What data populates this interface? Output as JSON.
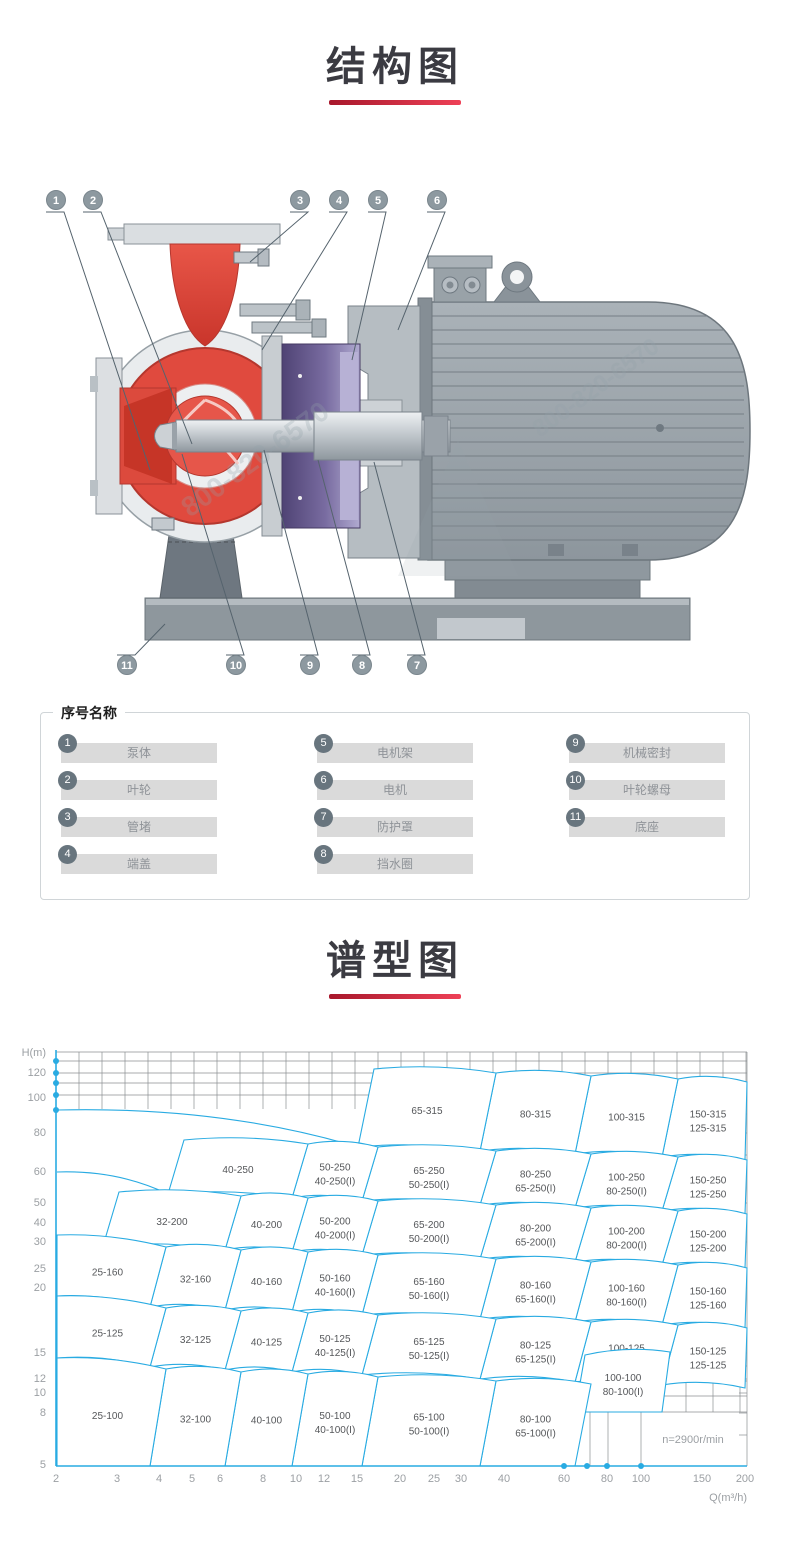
{
  "sections": {
    "structure": {
      "title": "结构图"
    },
    "spectrum": {
      "title": "谱型图"
    }
  },
  "accent": {
    "underline_from": "#a8182c",
    "underline_to": "#ee4157"
  },
  "figure": {
    "watermark": "800-820-6570",
    "colors": {
      "red": "#e04a3e",
      "dark_red": "#b5372e",
      "purple": "#5a4b7e",
      "motor_gray": "#9aa3a9",
      "base_gray": "#8e979d",
      "callout": "#8d99a0"
    },
    "callouts": [
      {
        "n": "1",
        "cx": 56,
        "cy": 22,
        "tx": 150,
        "ty": 292
      },
      {
        "n": "2",
        "cx": 93,
        "cy": 22,
        "tx": 192,
        "ty": 266
      },
      {
        "n": "3",
        "cx": 300,
        "cy": 22,
        "tx": 250,
        "ty": 84
      },
      {
        "n": "4",
        "cx": 339,
        "cy": 22,
        "tx": 262,
        "ty": 172
      },
      {
        "n": "5",
        "cx": 378,
        "cy": 22,
        "tx": 352,
        "ty": 182
      },
      {
        "n": "6",
        "cx": 437,
        "cy": 22,
        "tx": 398,
        "ty": 152
      },
      {
        "n": "11",
        "cx": 127,
        "cy": 487,
        "tx": 165,
        "ty": 446
      },
      {
        "n": "10",
        "cx": 236,
        "cy": 487,
        "tx": 182,
        "ty": 276
      },
      {
        "n": "9",
        "cx": 310,
        "cy": 487,
        "tx": 264,
        "ty": 272
      },
      {
        "n": "8",
        "cx": 362,
        "cy": 487,
        "tx": 318,
        "ty": 282
      },
      {
        "n": "7",
        "cx": 417,
        "cy": 487,
        "tx": 374,
        "ty": 284
      }
    ]
  },
  "legend": {
    "title": "序号名称",
    "items": [
      {
        "num": "1",
        "name": "泵体"
      },
      {
        "num": "2",
        "name": "叶轮"
      },
      {
        "num": "3",
        "name": "管堵"
      },
      {
        "num": "4",
        "name": "端盖"
      },
      {
        "num": "5",
        "name": "电机架"
      },
      {
        "num": "6",
        "name": "电机"
      },
      {
        "num": "7",
        "name": "防护罩"
      },
      {
        "num": "8",
        "name": "挡水圈"
      },
      {
        "num": "9",
        "name": "机械密封"
      },
      {
        "num": "10",
        "name": "叶轮螺母"
      },
      {
        "num": "11",
        "name": "底座"
      }
    ]
  },
  "chart_data": {
    "type": "area",
    "subtype": "pump-selection-map",
    "title": "谱型图",
    "xlabel": "Q(m³/h)",
    "ylabel": "H(m)",
    "x_scale": "log",
    "y_scale": "log",
    "x_range": [
      2,
      200
    ],
    "y_range": [
      5,
      140
    ],
    "annotation": {
      "text": "n=2900r/min",
      "x": 693,
      "y": 413
    },
    "style": {
      "axis": "#29abe2",
      "grid": "#8b8f92",
      "tick": "#9b9fa3",
      "label": "#55575a",
      "region_stroke": "#29abe2",
      "region_fill": "#ffffff"
    },
    "axes": {
      "x": 56,
      "y_top": 20,
      "y_bottom": 436,
      "x_right": 747
    },
    "x_ticks": [
      [
        "2",
        56
      ],
      [
        "3",
        117
      ],
      [
        "4",
        159
      ],
      [
        "5",
        192
      ],
      [
        "6",
        220
      ],
      [
        "8",
        263
      ],
      [
        "10",
        296
      ],
      [
        "12",
        324
      ],
      [
        "15",
        357
      ],
      [
        "20",
        400
      ],
      [
        "25",
        434
      ],
      [
        "30",
        461
      ],
      [
        "40",
        504
      ],
      [
        "60",
        564
      ],
      [
        "80",
        607
      ],
      [
        "100",
        641
      ],
      [
        "150",
        702
      ],
      [
        "200",
        745
      ]
    ],
    "y_ticks": [
      [
        "120",
        46
      ],
      [
        "100",
        71
      ],
      [
        "80",
        106
      ],
      [
        "60",
        145
      ],
      [
        "50",
        176
      ],
      [
        "40",
        196
      ],
      [
        "30",
        215
      ],
      [
        "25",
        242
      ],
      [
        "20",
        261
      ],
      [
        "15",
        326
      ],
      [
        "12",
        352
      ],
      [
        "10",
        366
      ],
      [
        "8",
        386
      ],
      [
        "5",
        438
      ]
    ],
    "dots": {
      "r": 3,
      "y_axis": [
        31,
        43,
        53,
        65,
        80
      ],
      "x_axis": [
        564,
        587,
        607,
        641
      ]
    },
    "grid": {
      "band_rows": [
        22,
        31,
        43,
        53,
        65
      ],
      "band_x1": 56,
      "band_x2": 747,
      "vlines": {
        "x1": 56,
        "x2": 746,
        "step": 23,
        "y1": 22,
        "y2": 79
      },
      "right_border": {
        "x": 747,
        "y1": 22,
        "y2": 436
      },
      "right_ticks": {
        "x1": 739,
        "x2": 747,
        "ys": [
          84,
          103,
          125,
          142,
          173,
          193,
          212,
          239,
          258,
          323,
          349,
          363,
          383,
          405
        ]
      },
      "patch": [
        [
          640,
          336,
          747,
          336
        ],
        [
          640,
          351,
          747,
          351
        ],
        [
          640,
          366,
          747,
          366
        ],
        [
          541,
          382,
          747,
          382
        ],
        [
          657,
          322,
          657,
          382
        ],
        [
          686,
          322,
          686,
          382
        ],
        [
          713,
          322,
          713,
          382
        ],
        [
          740,
          322,
          740,
          382
        ],
        [
          567,
          382,
          567,
          436
        ],
        [
          590,
          382,
          590,
          436
        ],
        [
          608,
          382,
          608,
          436
        ],
        [
          641,
          382,
          641,
          436
        ]
      ]
    },
    "extra_curves": [
      "M57,80 Q220,76 358,117",
      "M57,142 Q118,140 168,164"
    ],
    "regions": [
      {
        "l": [
          "150-315",
          "125-315"
        ],
        "p": [
          [
            662,
            127
          ],
          [
            745,
            130
          ],
          [
            747,
            52
          ],
          [
            678,
            49
          ]
        ]
      },
      {
        "l": [
          "100-315"
        ],
        "p": [
          [
            575,
            124
          ],
          [
            662,
            127
          ],
          [
            678,
            49
          ],
          [
            591,
            46
          ]
        ]
      },
      {
        "l": [
          "80-315"
        ],
        "p": [
          [
            480,
            121
          ],
          [
            575,
            124
          ],
          [
            591,
            46
          ],
          [
            496,
            43
          ]
        ]
      },
      {
        "l": [
          "65-315"
        ],
        "p": [
          [
            358,
            117
          ],
          [
            480,
            121
          ],
          [
            496,
            43
          ],
          [
            374,
            39
          ]
        ]
      },
      {
        "l": [
          "150-250",
          "125-250"
        ],
        "p": [
          [
            662,
            181
          ],
          [
            745,
            184
          ],
          [
            747,
            130
          ],
          [
            678,
            127
          ]
        ]
      },
      {
        "l": [
          "100-250",
          "80-250(I)"
        ],
        "p": [
          [
            575,
            178
          ],
          [
            662,
            181
          ],
          [
            678,
            127
          ],
          [
            591,
            124
          ]
        ]
      },
      {
        "l": [
          "80-250",
          "65-250(I)"
        ],
        "p": [
          [
            480,
            175
          ],
          [
            575,
            178
          ],
          [
            591,
            124
          ],
          [
            496,
            121
          ]
        ]
      },
      {
        "l": [
          "65-250",
          "50-250(I)"
        ],
        "p": [
          [
            362,
            171
          ],
          [
            480,
            175
          ],
          [
            496,
            121
          ],
          [
            378,
            117
          ]
        ]
      },
      {
        "l": [
          "50-250",
          "40-250(I)"
        ],
        "p": [
          [
            292,
            168
          ],
          [
            362,
            171
          ],
          [
            378,
            117
          ],
          [
            308,
            114
          ]
        ]
      },
      {
        "l": [
          "40-250"
        ],
        "p": [
          [
            168,
            164
          ],
          [
            292,
            168
          ],
          [
            308,
            114
          ],
          [
            184,
            110
          ]
        ]
      },
      {
        "l": [
          "150-200",
          "125-200"
        ],
        "p": [
          [
            662,
            235
          ],
          [
            745,
            238
          ],
          [
            747,
            184
          ],
          [
            678,
            181
          ]
        ]
      },
      {
        "l": [
          "100-200",
          "80-200(I)"
        ],
        "p": [
          [
            575,
            232
          ],
          [
            662,
            235
          ],
          [
            678,
            181
          ],
          [
            591,
            178
          ]
        ]
      },
      {
        "l": [
          "80-200",
          "65-200(I)"
        ],
        "p": [
          [
            480,
            229
          ],
          [
            575,
            232
          ],
          [
            591,
            178
          ],
          [
            496,
            175
          ]
        ]
      },
      {
        "l": [
          "65-200",
          "50-200(I)"
        ],
        "p": [
          [
            362,
            225
          ],
          [
            480,
            229
          ],
          [
            496,
            175
          ],
          [
            378,
            171
          ]
        ]
      },
      {
        "l": [
          "50-200",
          "40-200(I)"
        ],
        "p": [
          [
            292,
            222
          ],
          [
            362,
            225
          ],
          [
            378,
            171
          ],
          [
            308,
            168
          ]
        ]
      },
      {
        "l": [
          "40-200"
        ],
        "p": [
          [
            225,
            220
          ],
          [
            292,
            222
          ],
          [
            308,
            168
          ],
          [
            241,
            166
          ]
        ]
      },
      {
        "l": [
          "32-200"
        ],
        "p": [
          [
            103,
            216
          ],
          [
            225,
            220
          ],
          [
            241,
            166
          ],
          [
            119,
            162
          ]
        ]
      },
      {
        "l": [
          "150-160",
          "125-160"
        ],
        "p": [
          [
            662,
            295
          ],
          [
            745,
            298
          ],
          [
            747,
            238
          ],
          [
            678,
            235
          ]
        ]
      },
      {
        "l": [
          "100-160",
          "80-160(I)"
        ],
        "p": [
          [
            575,
            292
          ],
          [
            662,
            295
          ],
          [
            678,
            235
          ],
          [
            591,
            232
          ]
        ]
      },
      {
        "l": [
          "80-160",
          "65-160(I)"
        ],
        "p": [
          [
            480,
            289
          ],
          [
            575,
            292
          ],
          [
            591,
            232
          ],
          [
            496,
            229
          ]
        ]
      },
      {
        "l": [
          "65-160",
          "50-160(I)"
        ],
        "p": [
          [
            362,
            285
          ],
          [
            480,
            289
          ],
          [
            496,
            229
          ],
          [
            378,
            225
          ]
        ]
      },
      {
        "l": [
          "50-160",
          "40-160(I)"
        ],
        "p": [
          [
            292,
            282
          ],
          [
            362,
            285
          ],
          [
            378,
            225
          ],
          [
            308,
            222
          ]
        ]
      },
      {
        "l": [
          "40-160"
        ],
        "p": [
          [
            225,
            280
          ],
          [
            292,
            282
          ],
          [
            308,
            222
          ],
          [
            241,
            220
          ]
        ]
      },
      {
        "l": [
          "32-160"
        ],
        "p": [
          [
            150,
            277
          ],
          [
            225,
            280
          ],
          [
            241,
            220
          ],
          [
            166,
            217
          ]
        ]
      },
      {
        "l": [
          "25-160"
        ],
        "p": [
          [
            57,
            266
          ],
          [
            150,
            277
          ],
          [
            166,
            217
          ],
          [
            57,
            205
          ]
        ]
      },
      {
        "l": [
          "150-125",
          "125-125"
        ],
        "p": [
          [
            662,
            355
          ],
          [
            745,
            358
          ],
          [
            747,
            298
          ],
          [
            678,
            295
          ]
        ]
      },
      {
        "l": [
          "100-125",
          "80-125(I)"
        ],
        "p": [
          [
            575,
            352
          ],
          [
            662,
            355
          ],
          [
            678,
            295
          ],
          [
            591,
            292
          ]
        ]
      },
      {
        "l": [
          "80-125",
          "65-125(I)"
        ],
        "p": [
          [
            480,
            349
          ],
          [
            575,
            352
          ],
          [
            591,
            292
          ],
          [
            496,
            289
          ]
        ]
      },
      {
        "l": [
          "65-125",
          "50-125(I)"
        ],
        "p": [
          [
            362,
            345
          ],
          [
            480,
            349
          ],
          [
            496,
            289
          ],
          [
            378,
            285
          ]
        ]
      },
      {
        "l": [
          "50-125",
          "40-125(I)"
        ],
        "p": [
          [
            292,
            342
          ],
          [
            362,
            345
          ],
          [
            378,
            285
          ],
          [
            308,
            283
          ]
        ]
      },
      {
        "l": [
          "40-125"
        ],
        "p": [
          [
            225,
            340
          ],
          [
            292,
            342
          ],
          [
            308,
            283
          ],
          [
            241,
            281
          ]
        ]
      },
      {
        "l": [
          "32-125"
        ],
        "p": [
          [
            150,
            337
          ],
          [
            225,
            340
          ],
          [
            241,
            281
          ],
          [
            166,
            278
          ]
        ]
      },
      {
        "l": [
          "25-125"
        ],
        "p": [
          [
            57,
            328
          ],
          [
            150,
            337
          ],
          [
            166,
            278
          ],
          [
            57,
            266
          ]
        ]
      },
      {
        "l": [
          "100-100",
          "80-100(I)"
        ],
        "f": 1,
        "p": [
          [
            575,
            382
          ],
          [
            662,
            382
          ],
          [
            670,
            322
          ],
          [
            585,
            325
          ]
        ]
      },
      {
        "l": [
          "80-100",
          "65-100(I)"
        ],
        "f": 1,
        "p": [
          [
            480,
            436
          ],
          [
            575,
            436
          ],
          [
            591,
            354
          ],
          [
            496,
            351
          ]
        ]
      },
      {
        "l": [
          "65-100",
          "50-100(I)"
        ],
        "f": 1,
        "p": [
          [
            362,
            436
          ],
          [
            480,
            436
          ],
          [
            496,
            351
          ],
          [
            378,
            347
          ]
        ]
      },
      {
        "l": [
          "50-100",
          "40-100(I)"
        ],
        "f": 1,
        "p": [
          [
            292,
            436
          ],
          [
            362,
            436
          ],
          [
            378,
            347
          ],
          [
            308,
            344
          ]
        ]
      },
      {
        "l": [
          "40-100"
        ],
        "f": 1,
        "p": [
          [
            225,
            436
          ],
          [
            292,
            436
          ],
          [
            308,
            344
          ],
          [
            241,
            342
          ]
        ]
      },
      {
        "l": [
          "32-100"
        ],
        "f": 1,
        "p": [
          [
            150,
            436
          ],
          [
            225,
            436
          ],
          [
            241,
            342
          ],
          [
            166,
            339
          ]
        ]
      },
      {
        "l": [
          "25-100"
        ],
        "f": 1,
        "p": [
          [
            57,
            436
          ],
          [
            150,
            436
          ],
          [
            166,
            339
          ],
          [
            57,
            328
          ]
        ]
      }
    ]
  }
}
